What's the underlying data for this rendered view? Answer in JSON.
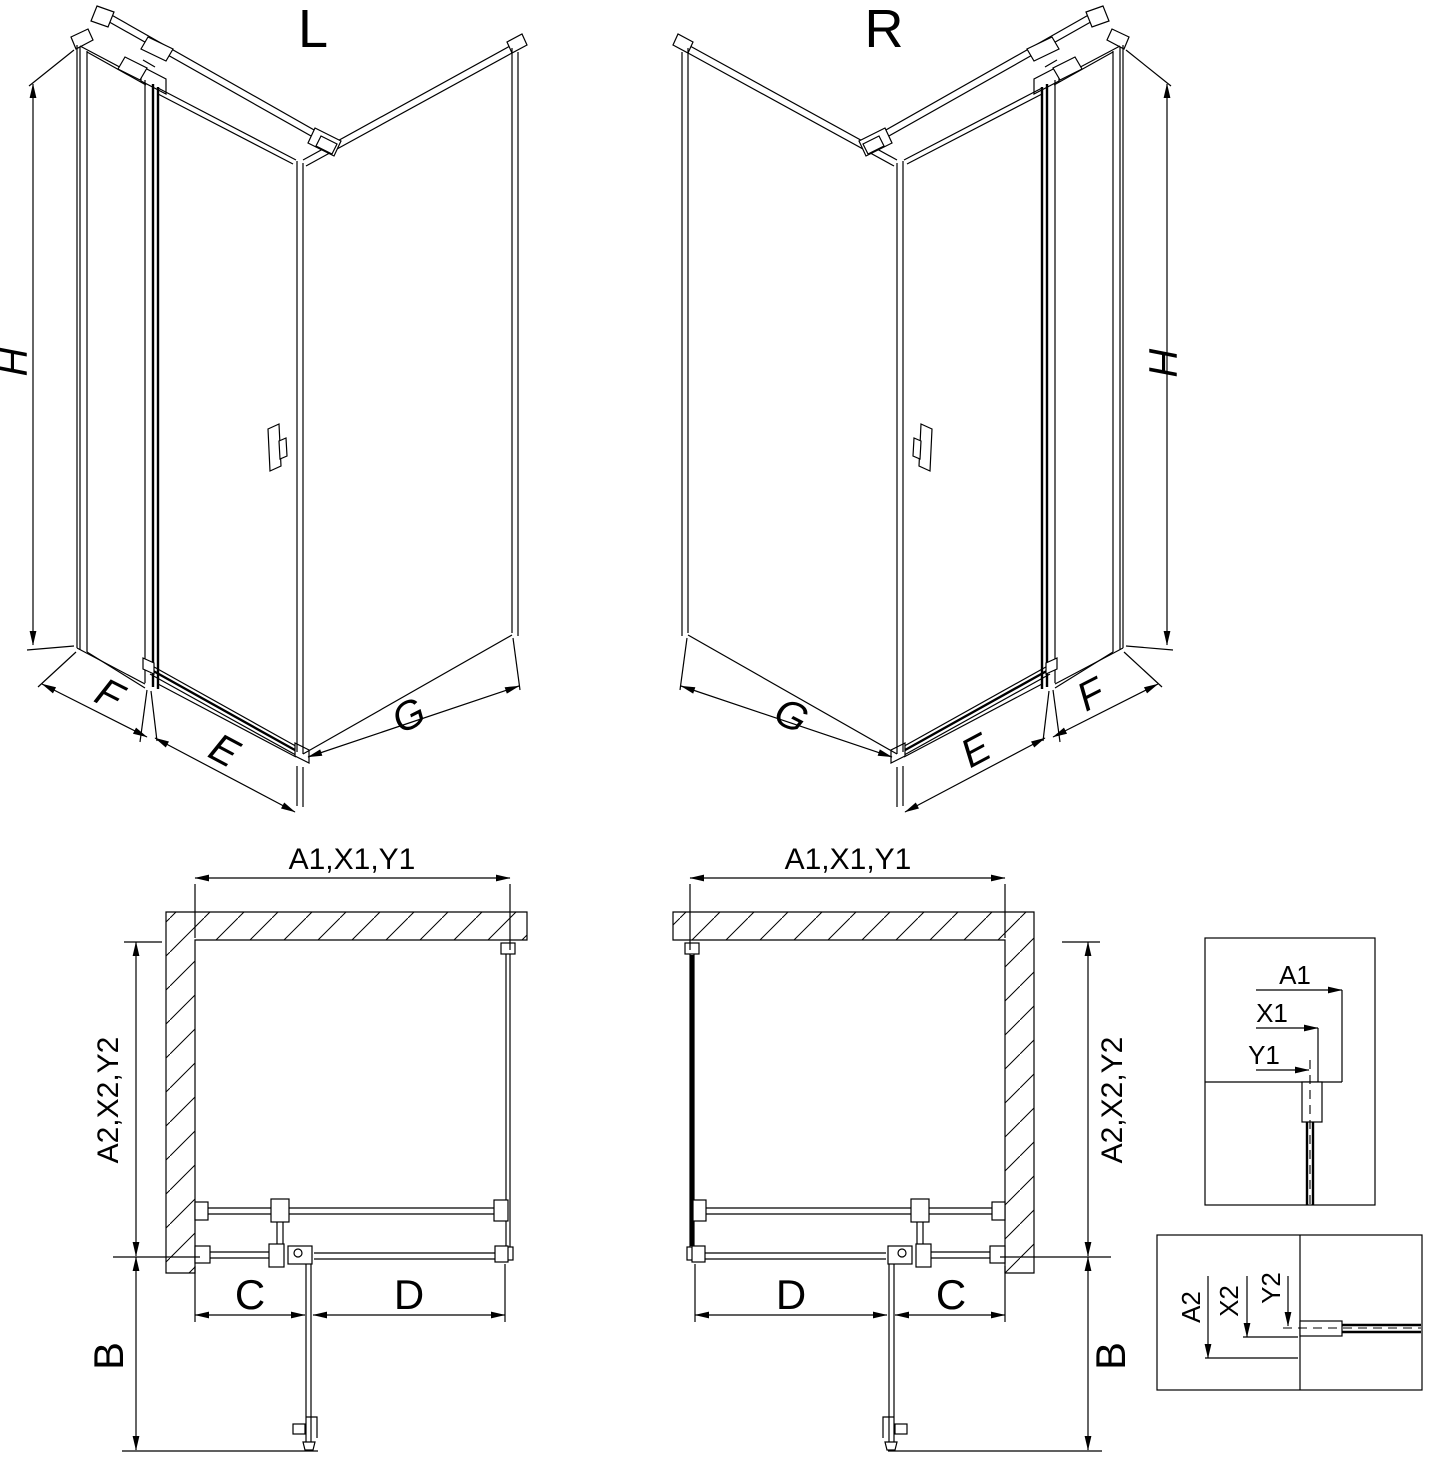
{
  "page": {
    "background": "#ffffff",
    "line_color": "#000000"
  },
  "views_3d": {
    "left": {
      "title": "L",
      "height_label": "H",
      "side_panel_label": "F",
      "door_label": "E",
      "return_panel_label": "G"
    },
    "right": {
      "title": "R",
      "height_label": "H",
      "side_panel_label": "F",
      "door_label": "E",
      "return_panel_label": "G"
    }
  },
  "plan_views": {
    "left": {
      "top_width_label": "A1,X1,Y1",
      "depth_label": "A2,X2,Y2",
      "door_swing_label": "B",
      "fixed_segment_label": "C",
      "door_segment_label": "D"
    },
    "right": {
      "top_width_label": "A1,X1,Y1",
      "depth_label": "A2,X2,Y2",
      "door_swing_label": "B",
      "fixed_segment_label": "C",
      "door_segment_label": "D"
    }
  },
  "detail_insets": {
    "width_reference": {
      "wall_label": "A1",
      "profile_label": "X1",
      "glass_label": "Y1"
    },
    "depth_reference": {
      "wall_label": "A2",
      "profile_label": "X2",
      "glass_label": "Y2"
    }
  }
}
